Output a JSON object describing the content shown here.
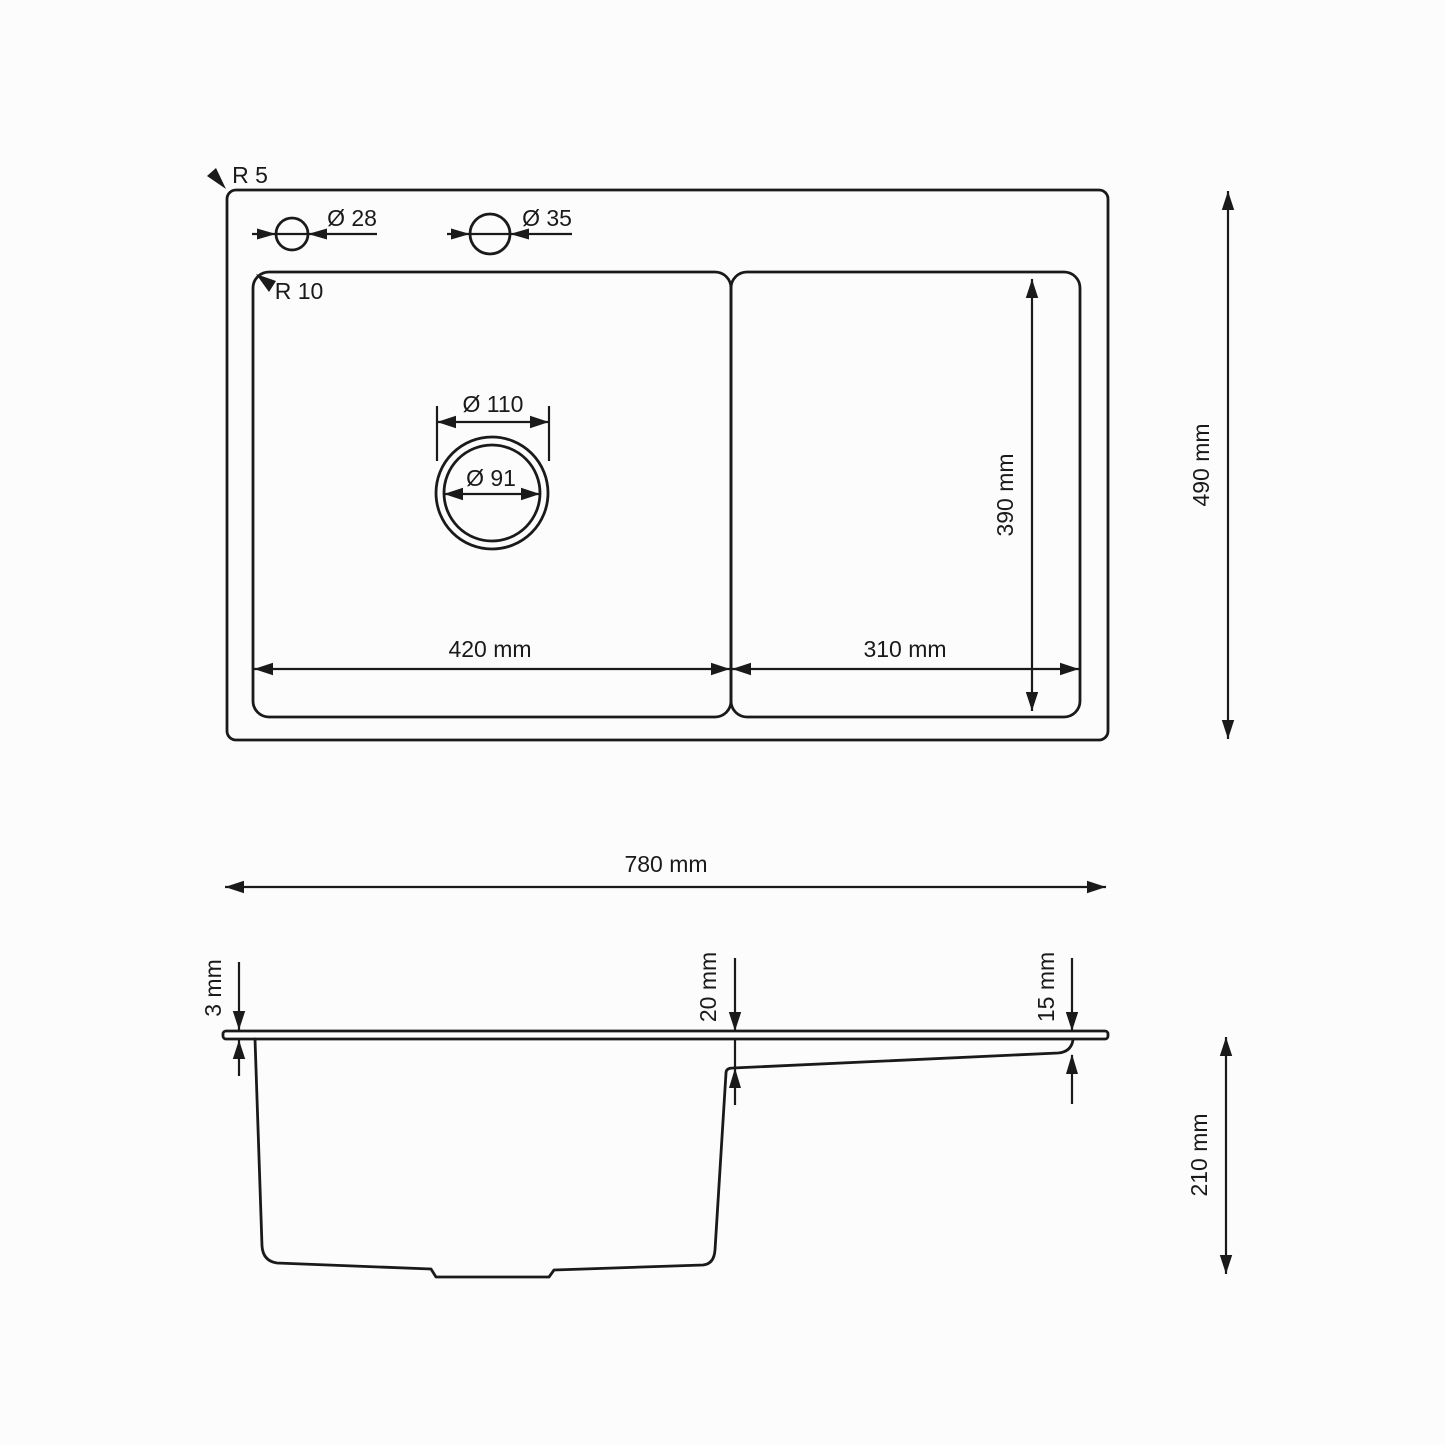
{
  "drawing_title": "Kitchen sink dimension drawing",
  "colors": {
    "line": "#1a1a1a",
    "background": "#fcfcfc"
  },
  "top_view": {
    "corner_radius_outer": "R 5",
    "corner_radius_inner": "R 10",
    "faucet_hole_small": "Ø 28",
    "faucet_hole_large": "Ø 35",
    "drain_outer_diameter": "Ø 110",
    "drain_inner_diameter": "Ø 91",
    "bowl_width": "420 mm",
    "drainer_width": "310 mm",
    "inner_depth": "390 mm",
    "overall_depth": "490 mm"
  },
  "overall": {
    "width": "780 mm"
  },
  "side_view": {
    "rim_thickness": "3 mm",
    "bowl_step_depth": "20 mm",
    "drainer_step_depth": "15 mm",
    "bowl_depth": "210 mm"
  }
}
